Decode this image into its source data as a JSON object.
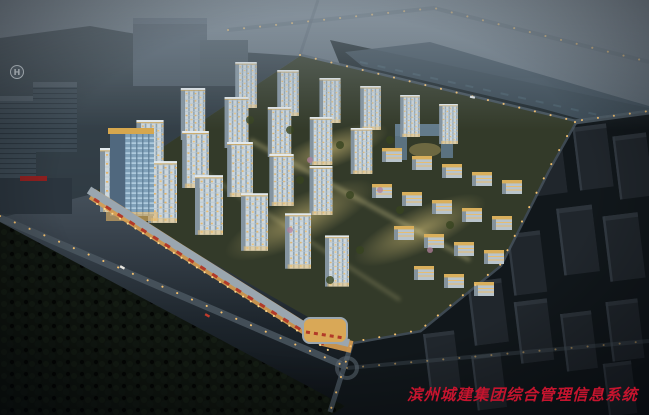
{
  "watermark": {
    "text": "滨州城建集团综合管理信息系统",
    "color": "#c5142e"
  },
  "scene": {
    "helipad_label": "H"
  },
  "palette": {
    "sky_top": "#76828d",
    "dusk_mid": "#3b454f",
    "night_ground": "#0c1014",
    "warm_window": "#eec27a",
    "facade_light": "#ccd6dc",
    "awning_red": "#b23a28",
    "forest_dark": "#0f150f",
    "dark_tower": "#20262c",
    "river": "#3e4e5a",
    "road": "#55616b",
    "streetlight": "#f4c06e"
  }
}
